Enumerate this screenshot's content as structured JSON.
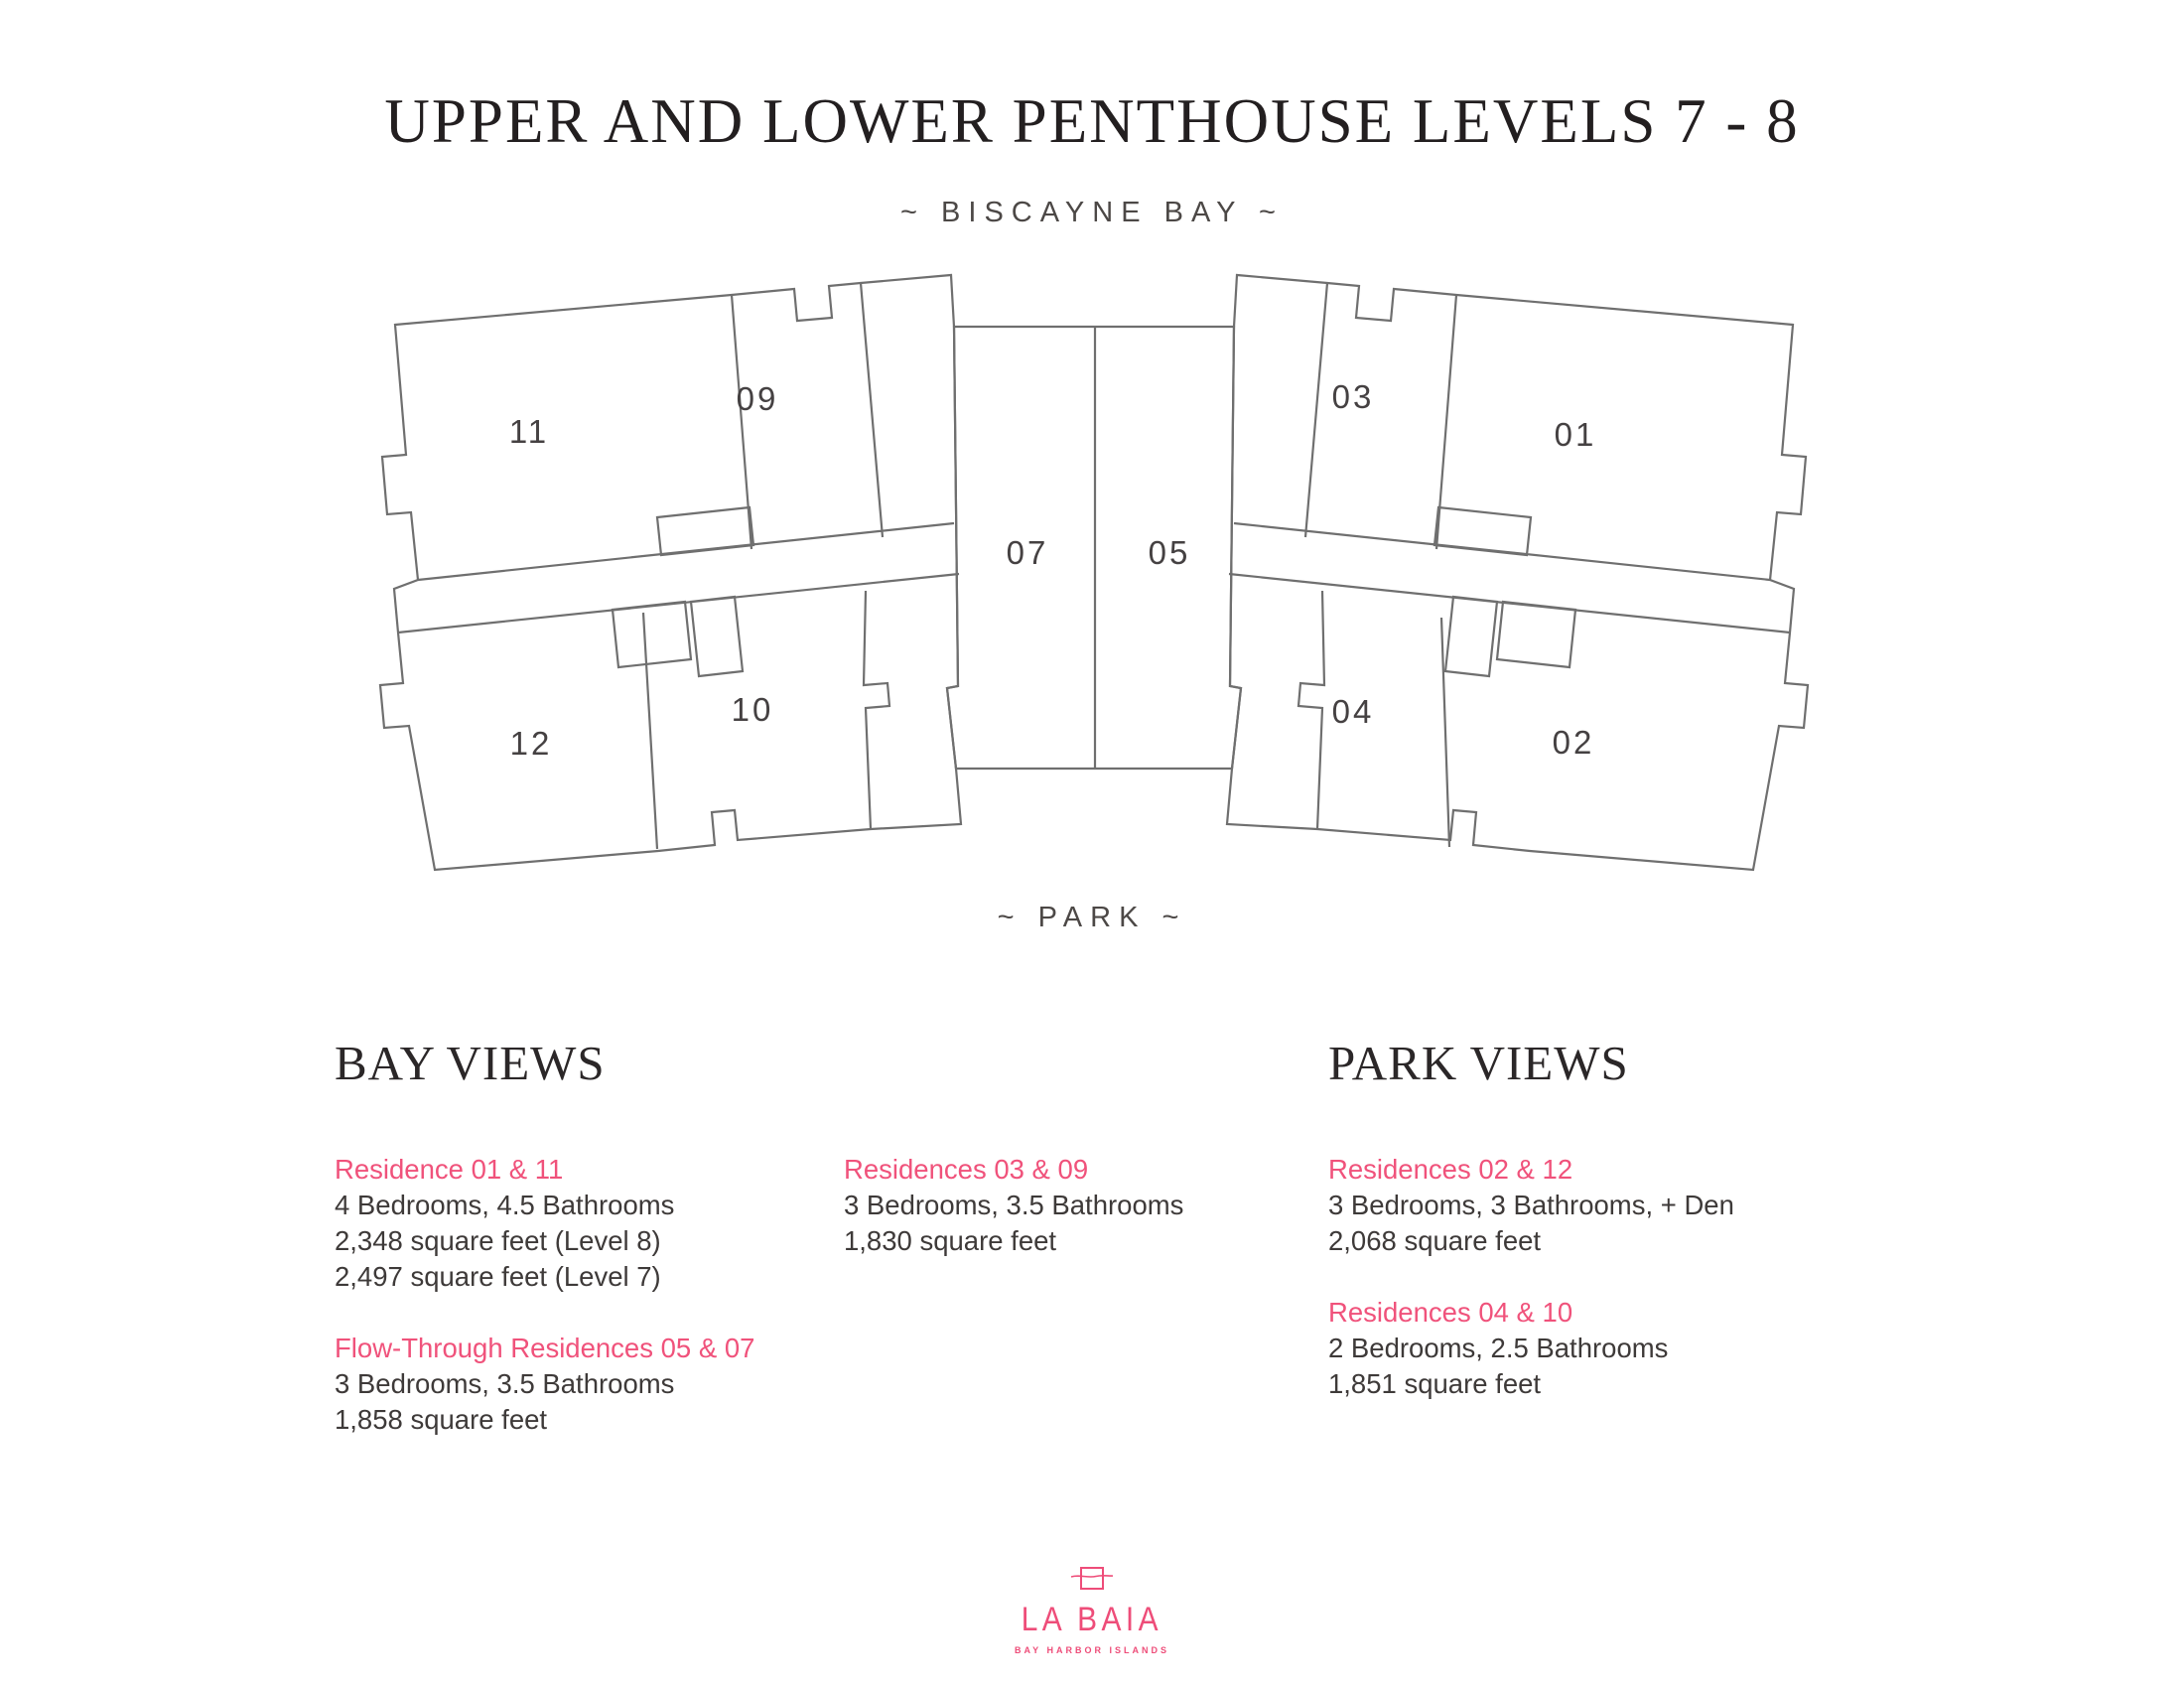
{
  "title": "UPPER AND LOWER PENTHOUSE LEVELS 7 - 8",
  "orientation": {
    "top_label": "~ BISCAYNE BAY ~",
    "bottom_label": "~ PARK ~"
  },
  "plan": {
    "unit_labels": {
      "u11": "11",
      "u09": "09",
      "u07": "07",
      "u05": "05",
      "u03": "03",
      "u01": "01",
      "u12": "12",
      "u10": "10",
      "u04": "04",
      "u02": "02"
    }
  },
  "sections": {
    "bay": {
      "heading": "BAY VIEWS",
      "blocks": [
        {
          "title": "Residence 01 & 11",
          "lines": [
            "4 Bedrooms, 4.5 Bathrooms",
            "2,348 square feet (Level 8)",
            "2,497 square feet (Level 7)"
          ]
        },
        {
          "title": "Flow-Through Residences 05 & 07",
          "lines": [
            "3 Bedrooms, 3.5 Bathrooms",
            "1,858 square feet"
          ]
        },
        {
          "title": "Residences 03 & 09",
          "lines": [
            "3 Bedrooms, 3.5 Bathrooms",
            "1,830 square feet"
          ]
        }
      ]
    },
    "park": {
      "heading": "PARK VIEWS",
      "blocks": [
        {
          "title": "Residences 02 & 12",
          "lines": [
            "3 Bedrooms, 3 Bathrooms, + Den",
            "2,068 square feet"
          ]
        },
        {
          "title": "Residences 04 & 10",
          "lines": [
            "2 Bedrooms, 2.5 Bathrooms",
            "1,851 square feet"
          ]
        }
      ]
    }
  },
  "logo": {
    "name": "LA BAIA",
    "tagline": "BAY HARBOR ISLANDS"
  },
  "colors": {
    "accent_pink": "#f0527b",
    "logo_pink": "#ee4d79",
    "plan_line_gray": "#6f6f6f",
    "text_dark": "#3e3a39",
    "title_dark": "#231f20"
  }
}
